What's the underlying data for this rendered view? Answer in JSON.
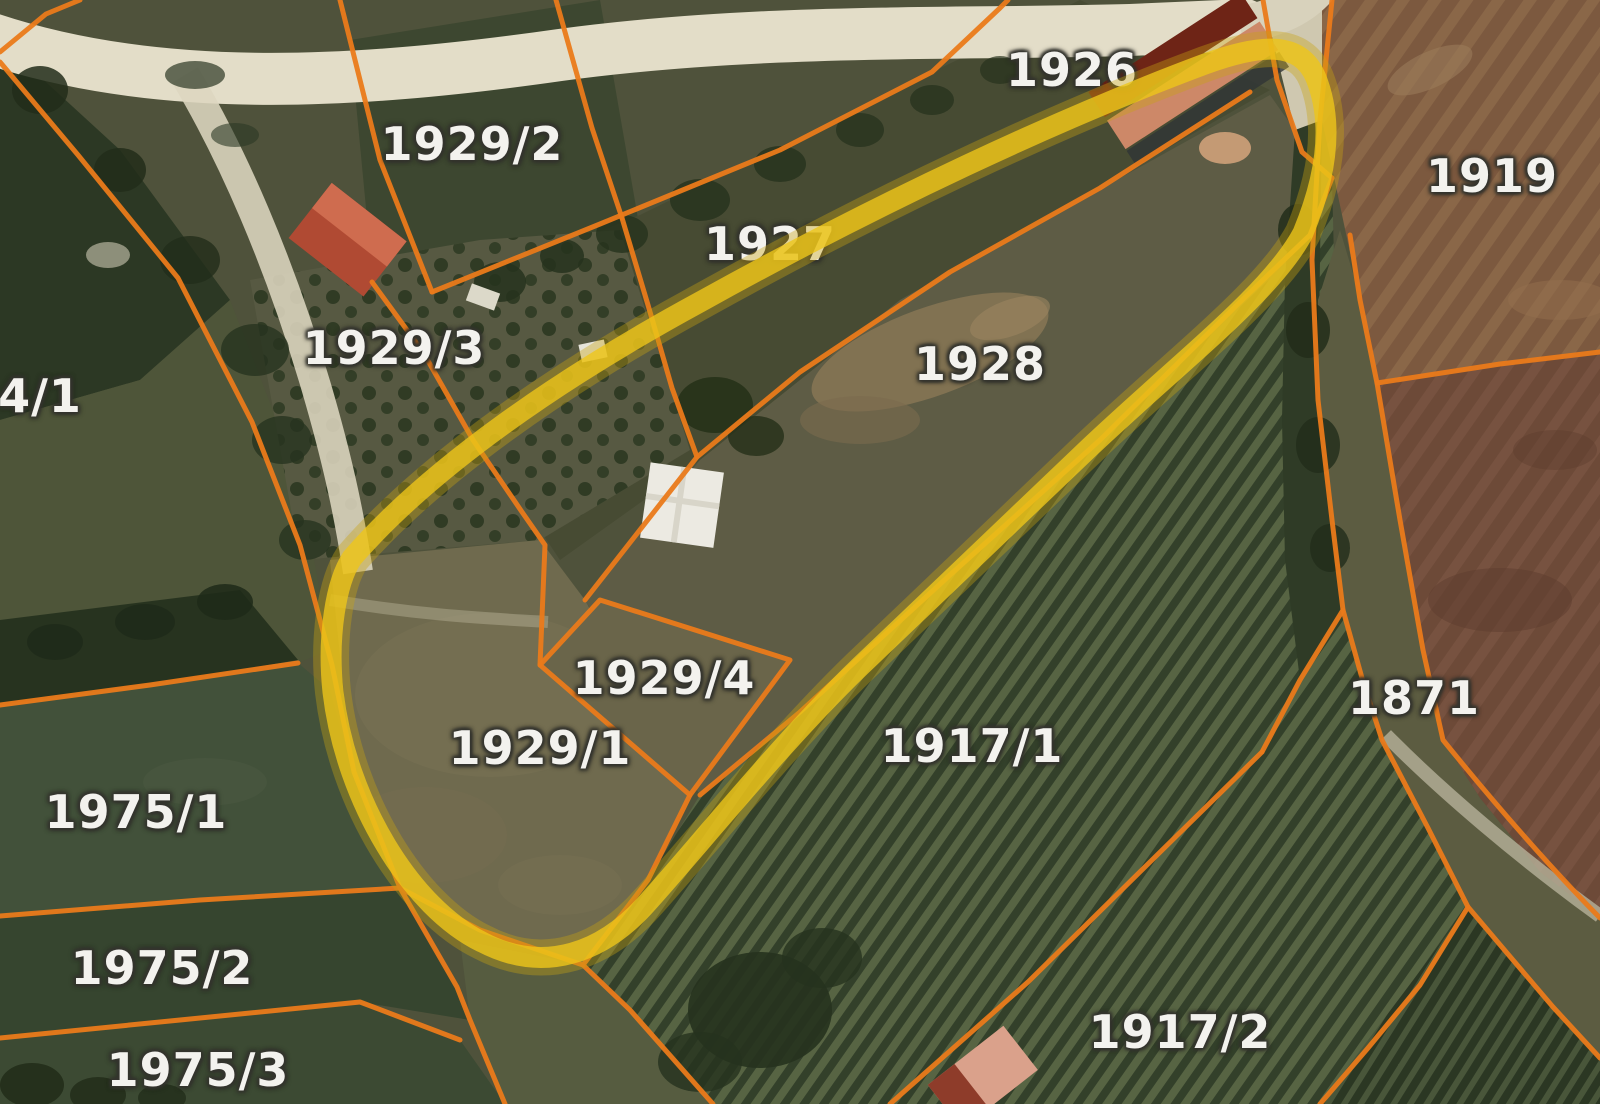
{
  "view": {
    "description": "Satellite cadastral parcel map with orange parcel boundaries and a yellow highlighted area",
    "colors": {
      "parcel_boundary": "#ea7a1a",
      "highlight": "#eec51a",
      "label_fill": "#f3f2ee",
      "label_outline": "#35352f"
    },
    "labels": [
      {
        "text": "1929/2"
      },
      {
        "text": "1926"
      },
      {
        "text": "1919"
      },
      {
        "text": "1927"
      },
      {
        "text": "1929/3"
      },
      {
        "text": "1928"
      },
      {
        "text": "4/1"
      },
      {
        "text": "1929/4"
      },
      {
        "text": "1871"
      },
      {
        "text": "1929/1"
      },
      {
        "text": "1917/1"
      },
      {
        "text": "1975/1"
      },
      {
        "text": "1975/2"
      },
      {
        "text": "1975/3"
      },
      {
        "text": "1917/2"
      }
    ]
  }
}
